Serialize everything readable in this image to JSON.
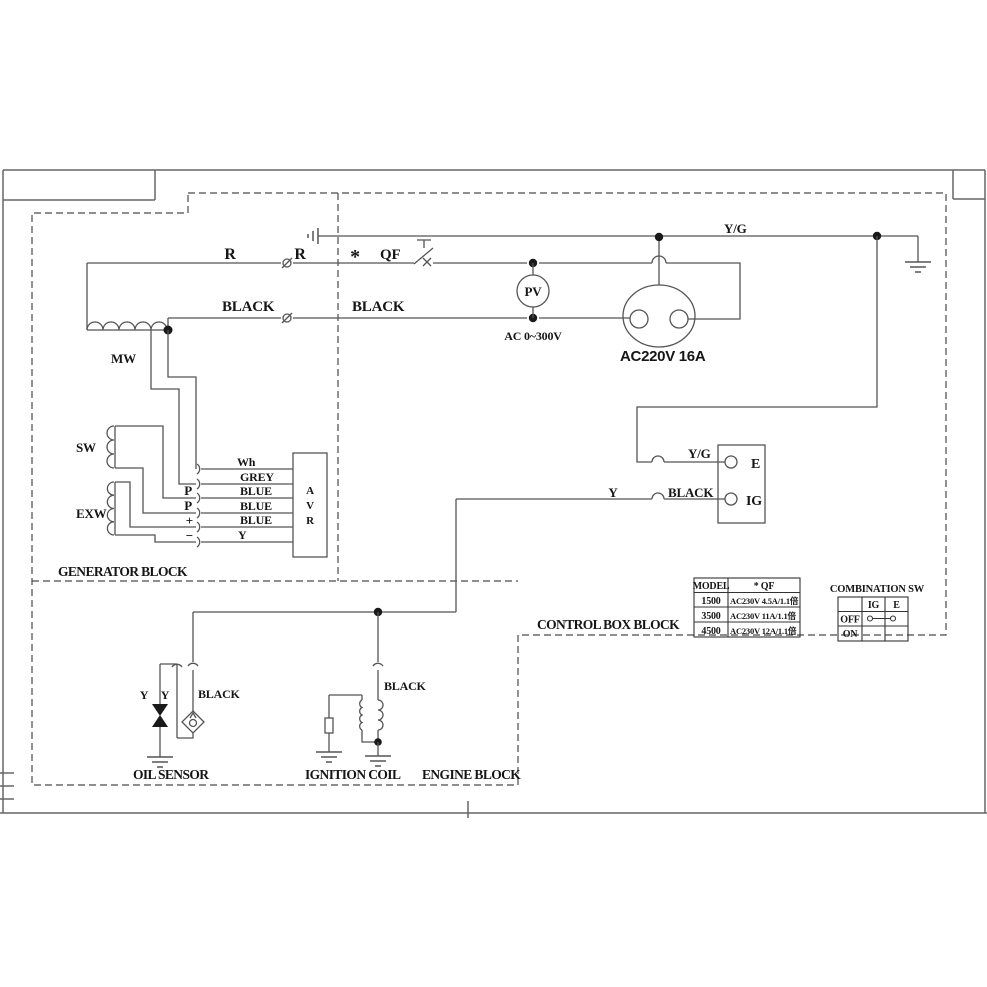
{
  "power": {
    "r_left": "R",
    "r_right": "R",
    "star": "*",
    "breaker": "QF",
    "black_left": "BLACK",
    "black_right": "BLACK",
    "ground_wire": "Y/G",
    "meter": "PV",
    "meter_range": "AC 0~300V",
    "socket": "AC220V 16A"
  },
  "generator": {
    "label": "GENERATOR BLOCK",
    "main_winding": "MW",
    "sensing_winding": "SW",
    "excitation_winding": "EXW",
    "avr": {
      "a": "A",
      "v": "V",
      "r": "R"
    },
    "pins": {
      "p1": "P",
      "p2": "P",
      "plus": "+",
      "minus": "−"
    },
    "wires": {
      "white": "Wh",
      "grey": "GREY",
      "blue1": "BLUE",
      "blue2": "BLUE",
      "blue3": "BLUE",
      "yellow": "Y"
    }
  },
  "control_box": {
    "label": "CONTROL BOX BLOCK",
    "terminal_e": "E",
    "terminal_ig": "IG",
    "e_wire": "Y/G",
    "ig_wire_color": "Y",
    "ig_wire": "BLACK"
  },
  "engine": {
    "label": "ENGINE BLOCK",
    "oil_sensor": {
      "label": "OIL SENSOR",
      "wire_y1": "Y",
      "wire_y2": "Y",
      "wire_black": "BLACK"
    },
    "ignition": {
      "label": "IGNITION COIL",
      "wire_black": "BLACK"
    }
  },
  "model_table": {
    "headers": [
      "MODEL",
      "* QF"
    ],
    "rows": [
      [
        "1500",
        "AC230V 4.5A/1.1倍"
      ],
      [
        "3500",
        "AC230V 11A/1.1倍"
      ],
      [
        "4500",
        "AC230V 12A/1.1倍"
      ]
    ]
  },
  "combination_sw": {
    "title": "COMBINATION SW",
    "columns": [
      "IG",
      "E"
    ],
    "states": [
      "OFF",
      "ON"
    ]
  },
  "colors": {
    "wire": "#555555",
    "text": "#161616",
    "frame": "#666666",
    "background": "#ffffff"
  }
}
